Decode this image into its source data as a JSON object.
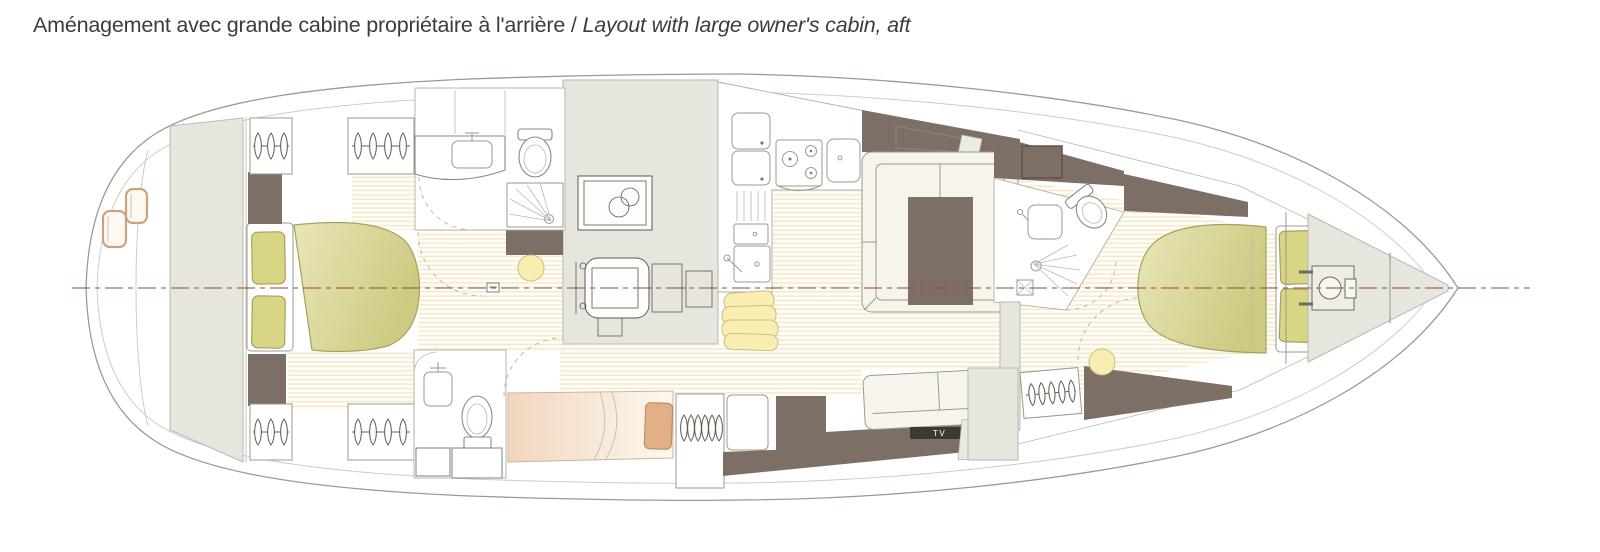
{
  "header": {
    "title_fr": "Aménagement avec grande cabine propriétaire à l'arrière",
    "separator": " / ",
    "title_en": "Layout with large owner's cabin, aft"
  },
  "plan": {
    "labels": {
      "tv": "TV"
    },
    "icons": [
      "hanger-icon",
      "windlass-icon",
      "toilet-icon",
      "washbasin-icon",
      "shower-icon",
      "stove-icon",
      "sink-icon",
      "engine-icon",
      "generator-icon",
      "bed-icon",
      "pillow-icon",
      "saloon-table-icon",
      "sofa-icon",
      "stool-icon",
      "tv-icon",
      "transom-step-icon"
    ]
  },
  "colors": {
    "title_text": "#3d3d3d",
    "hull_outline": "#9b9b91",
    "inner_line": "#cdcdc3",
    "panel_gray": "#e6e6de",
    "panel_border": "#b9b9ae",
    "taupe_brown": "#7d6e66",
    "taupe_dark": "#60544d",
    "ivory": "#f7f4ec",
    "furniture_stroke": "#9a9a90",
    "olive_bed_light": "#e8e6b6",
    "olive_bed_dark": "#cdca82",
    "olive_stroke": "#a6a15f",
    "pillow_olive": "#d8d584",
    "floor_stripe": "#f3e8ca",
    "centerline_red": "#9c4f44",
    "peach_bed": "#f2d6be",
    "salmon_pillow": "#e2af87",
    "butter_yellow": "#f8eeb2",
    "butter_stroke": "#ccbd7f",
    "tan_step": "#c9a27f",
    "tv_bar": "#3e3833"
  }
}
